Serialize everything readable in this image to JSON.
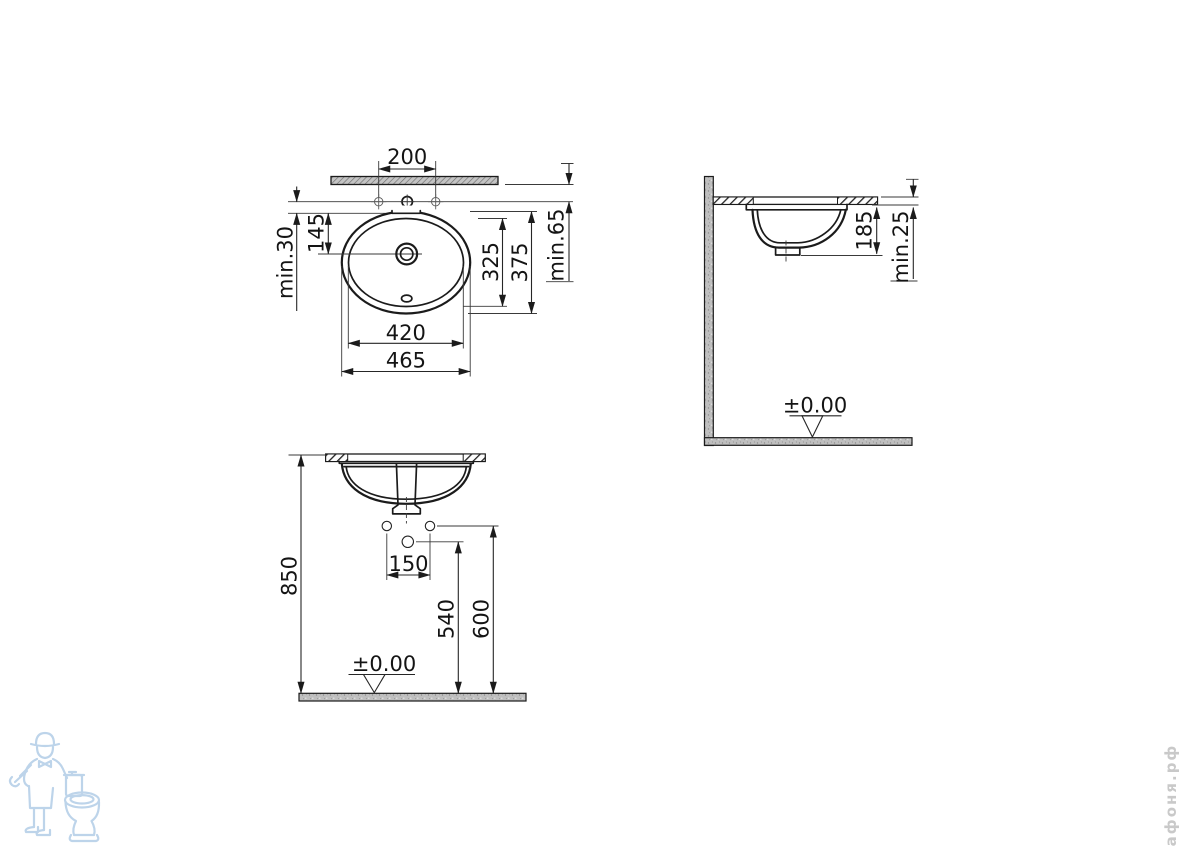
{
  "colors": {
    "line": "#1b1b1b",
    "dimension_line": "#262626",
    "counter_gray": "#c4c4c4",
    "watermark_blue": "#bdd4ea",
    "brand_gray": "#c9c9c9"
  },
  "views": {
    "plan": {
      "dims": {
        "tap_spacing": "200",
        "rim_gap_min": "min.30",
        "rim_to_drain": "145",
        "inner_depth": "325",
        "outer_depth": "375",
        "edge_to_tap_min": "min.65",
        "inner_width": "420",
        "outer_width": "465"
      }
    },
    "side": {
      "dims": {
        "bowl_height": "185",
        "counter_thickness_min": "min.25",
        "floor_datum": "±0.00"
      }
    },
    "front": {
      "dims": {
        "counter_height": "850",
        "supply_spacing": "150",
        "drain_height": "540",
        "supply_height": "600",
        "floor_datum": "±0.00"
      }
    }
  },
  "watermark": {
    "brand": "афоня.рф"
  }
}
